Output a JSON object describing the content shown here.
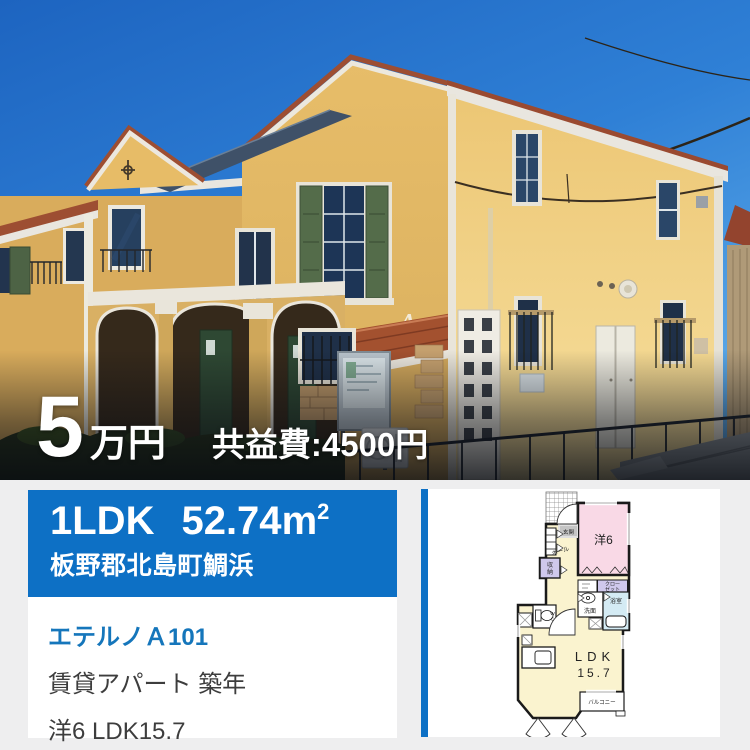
{
  "photo": {
    "price_amount": "5",
    "price_unit": "万円",
    "maintenance_fee": "共益費:4500円",
    "building_letter": "A"
  },
  "banner": {
    "layout_type": "1LDK",
    "area_value": "52.74",
    "area_unit": "m",
    "area_exponent": "2",
    "address": "板野郡北島町鯛浜",
    "accent_color": "#0d70c5"
  },
  "details": {
    "property_name": "エテルノＡ101",
    "property_type_line": "賃貸アパート 築年",
    "rooms_line": "洋6 LDK15.7",
    "link_color": "#1576bb"
  },
  "floorplan": {
    "entrance_label": "玄関",
    "hall_label": "ホール",
    "storage_char1": "収",
    "storage_char2": "納",
    "western_room_label": "洋6",
    "closet_line1": "クロー",
    "closet_line2": "ゼット",
    "washroom_label": "洗面",
    "bath_label": "浴室",
    "wc_char1": "W",
    "wc_char2": "C",
    "ldk_label": "LDK",
    "ldk_size": "15.7",
    "balcony_label": "バルコニー"
  }
}
